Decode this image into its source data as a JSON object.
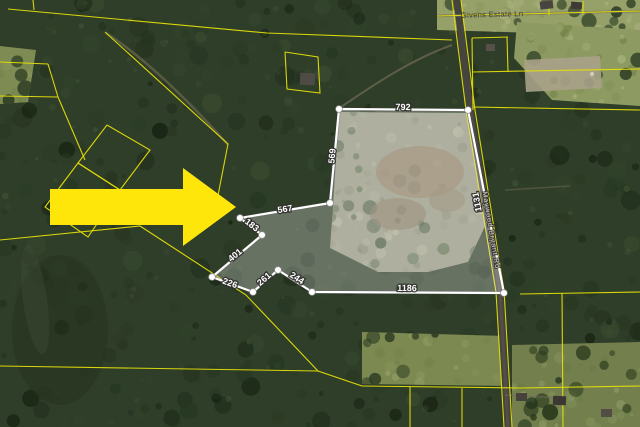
{
  "image": {
    "type": "aerial-parcel-map",
    "width": 640,
    "height": 427
  },
  "road_labels": [
    {
      "text": "Givens Estate Ln",
      "style": "street",
      "x": 492,
      "y": 14,
      "rot": -1.5
    },
    {
      "text": "Maywood Bryant Rd",
      "style": "on-road",
      "x": 492,
      "y": 230,
      "rot": 80.5
    }
  ],
  "parcel": {
    "boundary_color": "#ffffff",
    "vertices": [
      [
        339,
        109
      ],
      [
        468,
        110
      ],
      [
        504,
        293
      ],
      [
        312,
        292
      ],
      [
        278,
        270
      ],
      [
        253,
        292
      ],
      [
        212,
        277
      ],
      [
        262,
        235
      ],
      [
        240,
        218
      ],
      [
        330,
        203
      ]
    ],
    "edge_labels": [
      {
        "text": "792",
        "x": 403,
        "y": 107,
        "rot": 1
      },
      {
        "text": "1131",
        "x": 477,
        "y": 202,
        "rot": -100
      },
      {
        "text": "1186",
        "x": 407,
        "y": 288,
        "rot": 1
      },
      {
        "text": "244",
        "x": 297,
        "y": 278,
        "rot": 33
      },
      {
        "text": "261",
        "x": 264,
        "y": 279,
        "rot": -41
      },
      {
        "text": "226",
        "x": 230,
        "y": 283,
        "rot": 20
      },
      {
        "text": "401",
        "x": 235,
        "y": 255,
        "rot": -40
      },
      {
        "text": "183",
        "x": 252,
        "y": 225,
        "rot": 38
      },
      {
        "text": "567",
        "x": 285,
        "y": 209,
        "rot": -9
      },
      {
        "text": "569",
        "x": 332,
        "y": 156,
        "rot": -85
      }
    ]
  },
  "annotation_arrow": {
    "color": "#ffe60a",
    "direction": "right"
  },
  "colors": {
    "parcel_line": "#e4de0a",
    "forest_base": "#2f3e29",
    "road_fill": "#45443f"
  }
}
